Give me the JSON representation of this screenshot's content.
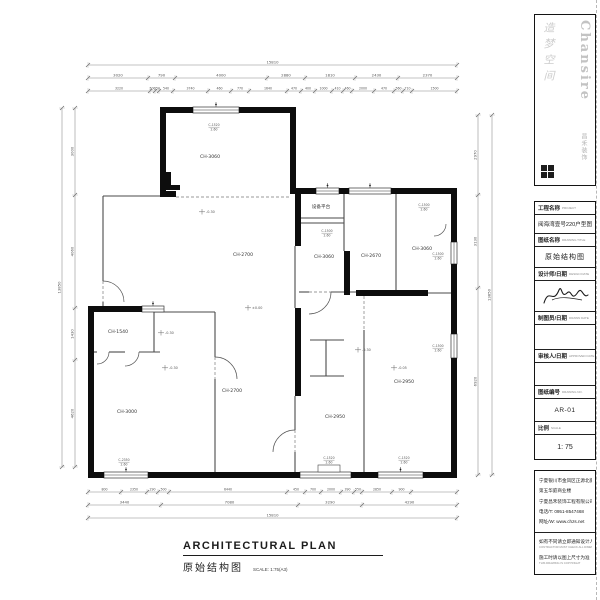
{
  "logo": {
    "brand": "Chansire",
    "tagline": "造梦空间",
    "sub": "昌禾装饰"
  },
  "title_block": {
    "project_label": "工程名称",
    "project_label_en": "PROJECT",
    "project_value": "阅海湾壹号220户型图",
    "drawing_label": "图纸名称",
    "drawing_label_en": "DRAWING TITLE",
    "drawing_value": "原始结构图",
    "designer_label": "设计师/日期",
    "designer_label_en": "DESIGN DATE",
    "drafter_label": "制图员/日期",
    "drafter_label_en": "DRAWN DATE",
    "auditor_label": "审核人/日期",
    "auditor_label_en": "APPROVED DATE",
    "number_label": "图纸编号",
    "number_label_en": "DRAWING NO.",
    "number_value": "AR-01",
    "scale_label": "比例",
    "scale_label_en": "SCALE",
    "scale_value": "1: 75"
  },
  "company": {
    "address1": "宁夏银川市金凤区正源北街",
    "address2": "第五华庭商业楼",
    "name": "宁夏昌禾装饰工程有限公司",
    "phone": "电话/T: 0951-8547468",
    "web": "网址/W: www.chzs.net"
  },
  "notes": {
    "line1": "如有不同请立即通知设计人员",
    "line1_en": "CONTRACTOR MUST CHECK ALL DIMENSIONS ON SITE",
    "line2": "施工时请以图上尺寸为准",
    "line2_en": "THIS DRAWING IS COPYRIGHT"
  },
  "footer": {
    "title_en": "ARCHITECTURAL PLAN",
    "title_cn": "原始结构图",
    "scale_note": "SCALE: 1:75(A3)"
  },
  "plan": {
    "room_labels": [
      {
        "t": "CH-3060",
        "x": 210,
        "y": 158
      },
      {
        "t": "设备平台",
        "x": 321,
        "y": 208
      },
      {
        "t": "CH-3060",
        "x": 324,
        "y": 258
      },
      {
        "t": "CH-2670",
        "x": 371,
        "y": 257
      },
      {
        "t": "CH-3060",
        "x": 422,
        "y": 250
      },
      {
        "t": "CH-2700",
        "x": 243,
        "y": 256
      },
      {
        "t": "CH-1540",
        "x": 118,
        "y": 333
      },
      {
        "t": "CH-3000",
        "x": 127,
        "y": 413
      },
      {
        "t": "CH-2700",
        "x": 232,
        "y": 392
      },
      {
        "t": "CH-2950",
        "x": 335,
        "y": 418
      },
      {
        "t": "CH-2950",
        "x": 404,
        "y": 383
      }
    ],
    "window_labels": [
      {
        "t": "C-1520",
        "s": "2.60",
        "x": 214,
        "y": 126
      },
      {
        "t": "C-1500",
        "s": "2.60",
        "x": 327,
        "y": 232
      },
      {
        "t": "C-1500",
        "s": "2.60",
        "x": 424,
        "y": 206
      },
      {
        "t": "C-1500",
        "s": "2.60",
        "x": 438,
        "y": 255
      },
      {
        "t": "C-1500",
        "s": "2.60",
        "x": 438,
        "y": 347
      },
      {
        "t": "C-2350",
        "s": "2.60",
        "x": 124,
        "y": 461
      },
      {
        "t": "C-1520",
        "s": "2.60",
        "x": 329,
        "y": 459
      },
      {
        "t": "C-1520",
        "s": "2.60",
        "x": 404,
        "y": 459
      }
    ],
    "level_marks": [
      {
        "t": "-0.30",
        "x": 207,
        "y": 213
      },
      {
        "t": "±0.00",
        "x": 253,
        "y": 309
      },
      {
        "t": "-0.30",
        "x": 166,
        "y": 334
      },
      {
        "t": "-0.30",
        "x": 170,
        "y": 369
      },
      {
        "t": "-0.30",
        "x": 363,
        "y": 351
      },
      {
        "t": "-0.05",
        "x": 399,
        "y": 369
      }
    ],
    "dimensions": [
      {
        "o": "h",
        "pos": 65,
        "ticks": [
          88,
          457
        ],
        "labels": [
          "15810"
        ]
      },
      {
        "o": "h",
        "pos": 78,
        "ticks": [
          88,
          148,
          175,
          267,
          305,
          355,
          398,
          457
        ],
        "labels": [
          "3020",
          "790",
          "4000",
          "2880",
          "1810",
          "2430",
          "2370"
        ]
      },
      {
        "o": "h",
        "pos": 91,
        "ticks": [
          88,
          150,
          155,
          159,
          173,
          208,
          231,
          249,
          287,
          301,
          315,
          332,
          343,
          352,
          374,
          394,
          403,
          412,
          457
        ],
        "labels": [
          "3220",
          "500",
          "150",
          "540",
          "3740",
          "460",
          "770",
          "1640",
          "470",
          "400",
          "1000",
          "410",
          "460",
          "2000",
          "470",
          "560",
          "710",
          "1500"
        ],
        "small": true
      },
      {
        "o": "h",
        "pos": 492,
        "ticks": [
          88,
          121,
          147,
          158,
          169,
          287,
          305,
          321,
          341,
          354,
          362,
          392,
          411,
          457
        ],
        "labels": [
          "800",
          "2350",
          "290",
          "500",
          "6440",
          "450",
          "700",
          "2000",
          "390",
          "550",
          "2850",
          "900",
          ""
        ],
        "small": true
      },
      {
        "o": "h",
        "pos": 505,
        "ticks": [
          88,
          161,
          298,
          362,
          457
        ],
        "labels": [
          "3440",
          "7080",
          "3290",
          "4290"
        ]
      },
      {
        "o": "h",
        "pos": 518,
        "ticks": [
          88,
          457
        ],
        "labels": [
          "15810"
        ]
      },
      {
        "o": "v",
        "pos": 75,
        "ticks": [
          108,
          195,
          308,
          360,
          467
        ],
        "labels": [
          "3000",
          "4060",
          "1430",
          "4620"
        ]
      },
      {
        "o": "v",
        "pos": 62,
        "ticks": [
          108,
          467
        ],
        "labels": [
          "13850"
        ]
      },
      {
        "o": "v",
        "pos": 478,
        "ticks": [
          115,
          195,
          288,
          475
        ],
        "labels": [
          "2970",
          "3130",
          "6920"
        ]
      },
      {
        "o": "v",
        "pos": 492,
        "ticks": [
          115,
          475
        ],
        "labels": [
          "13850"
        ]
      }
    ]
  }
}
